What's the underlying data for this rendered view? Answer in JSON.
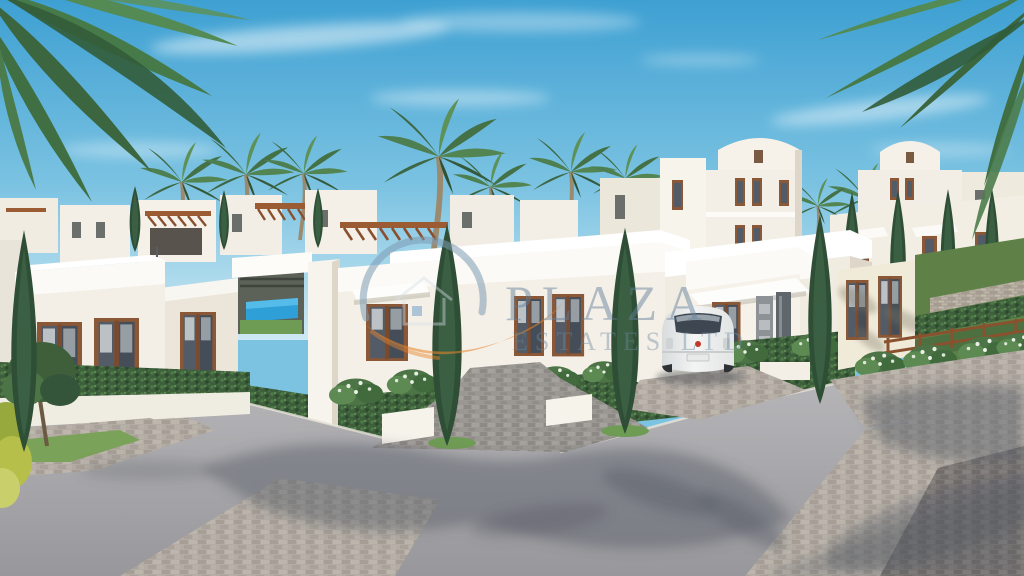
{
  "scene": {
    "type": "architectural-render",
    "objects": [
      "whitewashed single-storey villas",
      "two-storey villa with curved parapet",
      "palm trees",
      "cypress trees",
      "hedges and flowering shrubs",
      "glimpse of swimming pool",
      "wooden pergolas",
      "white hatchback car parked in driveway",
      "grey asphalt road with palm shadows",
      "brick paver driveway and sidewalks",
      "wooden garden fence and terraced garden",
      "blue sky with wispy clouds"
    ]
  },
  "watermark": {
    "line1": "PLAZA",
    "line2": "ESTATES LTD",
    "text_color": "#64809a",
    "swoosh_blue": "#7e9ab2",
    "swoosh_orange": "#e8862e"
  },
  "palette": {
    "sky_top": "#3ea0d2",
    "sky_horizon": "#cde9f3",
    "villa_front": "#f4f0e7",
    "villa_bright": "#fbfaf6",
    "villa_shade": "#ddd7ca",
    "window_frame_brown": "#8a5737",
    "window_glass": "#525b66",
    "pergola_wood": "#9c5c33",
    "hedge_green": "#3d5f3b",
    "cypress_green": "#2f4e36",
    "palm_green": "#4d7f50",
    "pool_blue": "#2f9fd8",
    "road_grey": "#a3a2a6",
    "road_shadow": "#555a63",
    "paver_light": "#b2aca4",
    "paver_dark": "#7b7673",
    "car_white": "#f1f2f1",
    "fence_brown": "#8a512f",
    "grass_green": "#6f9c54"
  }
}
